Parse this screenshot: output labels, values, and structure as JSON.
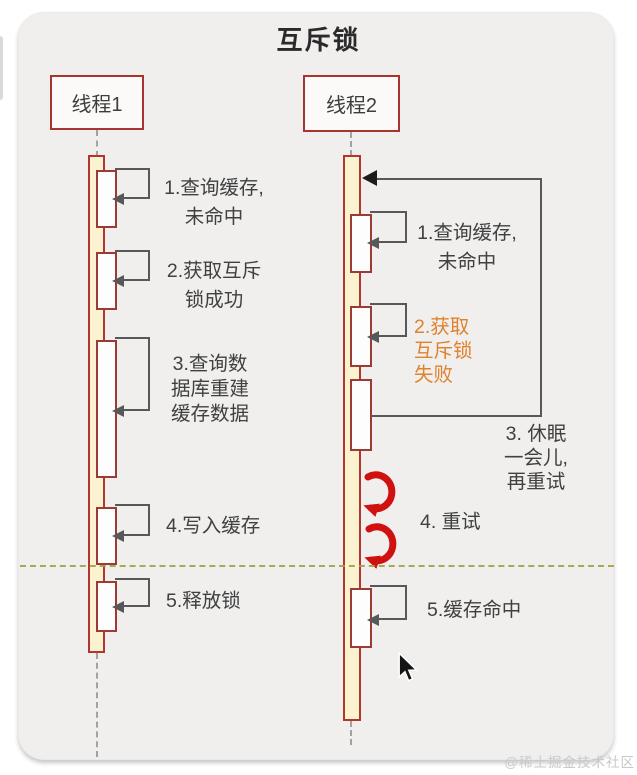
{
  "title": "互斥锁",
  "watermark": "@稀土掘金技术社区",
  "colors": {
    "card_background": "#f0efee",
    "actor_border": "#a83430",
    "activation_fill": "#fbf2cf",
    "activation_border": "#b23530",
    "box_fill": "#fdfdfd",
    "box_border": "#9c3a34",
    "message_arrow": "#58585a",
    "text": "#404040",
    "fail_text_orange": "#e0812c",
    "retry_arrow_red": "#cf1110",
    "divider_olive": "#9fa442"
  },
  "thread1": {
    "name": "线程1",
    "steps": [
      "1.查询缓存,\n未命中",
      "2.获取互斥\n锁成功",
      "3.查询数\n据库重建\n缓存数据",
      "4.写入缓存",
      "5.释放锁"
    ]
  },
  "thread2": {
    "name": "线程2",
    "steps": [
      "1.查询缓存,\n未命中",
      "2.获取\n互斥锁\n失败",
      "3. 休眠\n一会儿,\n再重试",
      "4. 重试",
      "5.缓存命中"
    ]
  }
}
